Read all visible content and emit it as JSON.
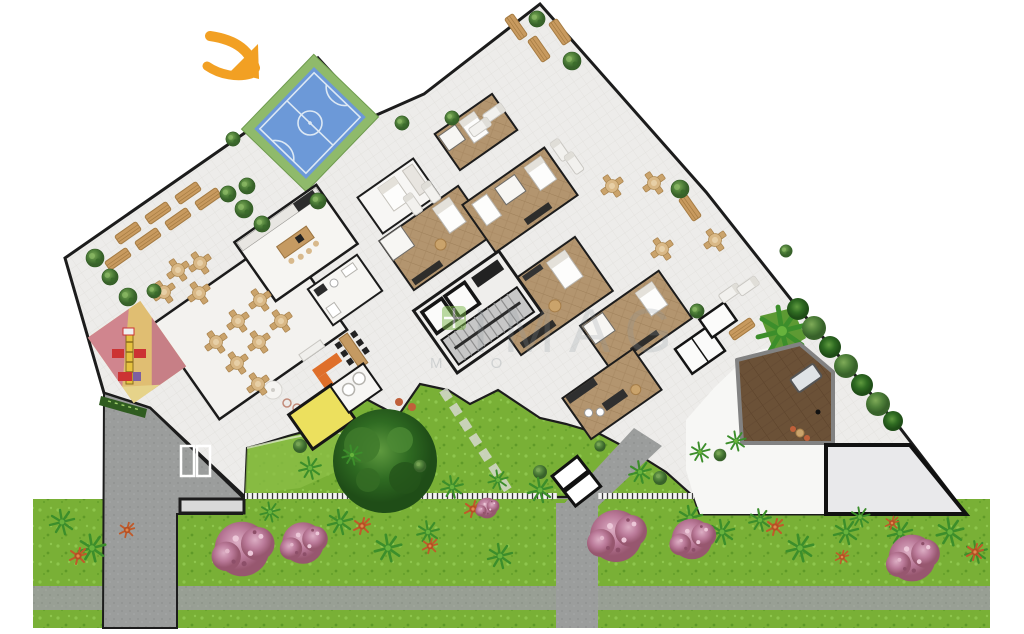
{
  "scene": {
    "type": "architectural-site-plan",
    "view": "top-down",
    "zones": [
      "sports-court",
      "roof-terrace",
      "party-room",
      "kitchen",
      "playground",
      "kids-room",
      "apartments",
      "elevator-stair-core",
      "wood-deck",
      "paved-court",
      "garden",
      "driveway",
      "sidewalk",
      "street-lawn"
    ]
  },
  "annotation": {
    "arrow_color": "#F2A023",
    "points_to": "sports-court"
  },
  "watermark": {
    "text": "IMAG",
    "subtext": "M O",
    "logo_color": "#7AB648"
  },
  "colors": {
    "background": "#FFFFFF",
    "floor": "#EDECEA",
    "wall": "#1C1C1C",
    "court_frame": "#8FBA6B",
    "court_surface": "#6C99D8",
    "court_lines": "#DCE8F4",
    "grass": "#79B036",
    "lawn_light": "#8CBF47",
    "road": "#9B9D9C",
    "sidewalk": "#A5A7A6",
    "wood_floor": "#B3956F",
    "deck": "#6B5137",
    "paved": "#E9E9EB",
    "pink_tree": "#C4829F",
    "tree": "#4E7F39",
    "palm": "#3C8E2B",
    "flower": "#C05A2A",
    "sofa": "#DF6F2A",
    "kids_room": "#ECE05E",
    "bench": "#C89A5F",
    "hedge": "#2F5C20"
  },
  "furniture": {
    "round_tables": [
      [
        178,
        270
      ],
      [
        200,
        263
      ],
      [
        164,
        292
      ],
      [
        199,
        293
      ],
      [
        260,
        300
      ],
      [
        238,
        321
      ],
      [
        216,
        342
      ],
      [
        281,
        321
      ],
      [
        259,
        342
      ],
      [
        237,
        363
      ],
      [
        258,
        384
      ],
      [
        612,
        186
      ],
      [
        654,
        183
      ],
      [
        662,
        249
      ],
      [
        715,
        240
      ]
    ],
    "benches": [
      [
        128,
        233,
        -35
      ],
      [
        158,
        213,
        -35
      ],
      [
        188,
        193,
        -35
      ],
      [
        118,
        259,
        -35
      ],
      [
        148,
        239,
        -35
      ],
      [
        178,
        219,
        -35
      ],
      [
        208,
        199,
        -35
      ],
      [
        516,
        27,
        55
      ],
      [
        539,
        49,
        55
      ],
      [
        560,
        32,
        55
      ],
      [
        690,
        208,
        55
      ],
      [
        742,
        329,
        -35
      ]
    ],
    "loungers": [
      [
        413,
        204,
        -35
      ],
      [
        431,
        192,
        -35
      ],
      [
        494,
        113,
        55
      ],
      [
        480,
        127,
        55
      ],
      [
        730,
        293,
        55
      ],
      [
        748,
        286,
        55
      ],
      [
        560,
        150,
        -35
      ],
      [
        574,
        163,
        -35
      ]
    ]
  },
  "vegetation": {
    "trees": [
      [
        95,
        258,
        1
      ],
      [
        110,
        277,
        0.9
      ],
      [
        128,
        297,
        1
      ],
      [
        154,
        291,
        0.8
      ],
      [
        228,
        194,
        0.9
      ],
      [
        244,
        209,
        1
      ],
      [
        262,
        224,
        0.9
      ],
      [
        233,
        139,
        0.8
      ],
      [
        247,
        186,
        0.9
      ],
      [
        318,
        201,
        0.9
      ],
      [
        537,
        19,
        0.9
      ],
      [
        572,
        61,
        1
      ],
      [
        680,
        189,
        1
      ],
      [
        402,
        123,
        0.8
      ],
      [
        452,
        118,
        0.8
      ],
      [
        697,
        311,
        0.8
      ],
      [
        786,
        251,
        0.7
      ]
    ],
    "palms": [
      [
        62,
        522,
        1
      ],
      [
        92,
        548,
        1.1
      ],
      [
        270,
        512,
        0.8
      ],
      [
        340,
        522,
        1
      ],
      [
        388,
        548,
        1.1
      ],
      [
        428,
        532,
        0.9
      ],
      [
        500,
        556,
        1
      ],
      [
        610,
        523,
        0.9
      ],
      [
        690,
        518,
        1
      ],
      [
        722,
        532,
        1
      ],
      [
        760,
        520,
        0.9
      ],
      [
        800,
        548,
        1.1
      ],
      [
        846,
        532,
        1
      ],
      [
        860,
        517,
        0.8
      ],
      [
        900,
        533,
        1
      ],
      [
        950,
        532,
        1.1
      ],
      [
        976,
        552,
        0.9
      ],
      [
        310,
        468,
        0.9
      ],
      [
        352,
        455,
        0.8
      ],
      [
        452,
        487,
        0.9
      ],
      [
        498,
        480,
        0.8
      ],
      [
        540,
        490,
        1
      ],
      [
        640,
        472,
        0.9
      ],
      [
        700,
        452,
        0.8
      ],
      [
        736,
        441,
        0.8
      ]
    ],
    "pink_trees": [
      [
        242,
        549,
        1.05
      ],
      [
        303,
        543,
        0.8
      ],
      [
        616,
        536,
        1.0
      ],
      [
        692,
        539,
        0.78
      ],
      [
        912,
        558,
        0.9
      ],
      [
        487,
        508,
        0.4
      ]
    ],
    "flowers": [
      [
        78,
        556,
        1
      ],
      [
        127,
        530,
        0.9
      ],
      [
        362,
        526,
        1
      ],
      [
        430,
        546,
        0.9
      ],
      [
        473,
        509,
        1
      ],
      [
        775,
        527,
        1
      ],
      [
        892,
        523,
        0.8
      ],
      [
        975,
        552,
        1
      ],
      [
        842,
        557,
        0.8
      ]
    ],
    "bushes": [
      [
        300,
        446,
        1
      ],
      [
        420,
        466,
        0.9
      ],
      [
        540,
        472,
        1
      ],
      [
        600,
        446,
        0.8
      ],
      [
        660,
        478,
        1
      ],
      [
        720,
        455,
        0.9
      ]
    ]
  }
}
